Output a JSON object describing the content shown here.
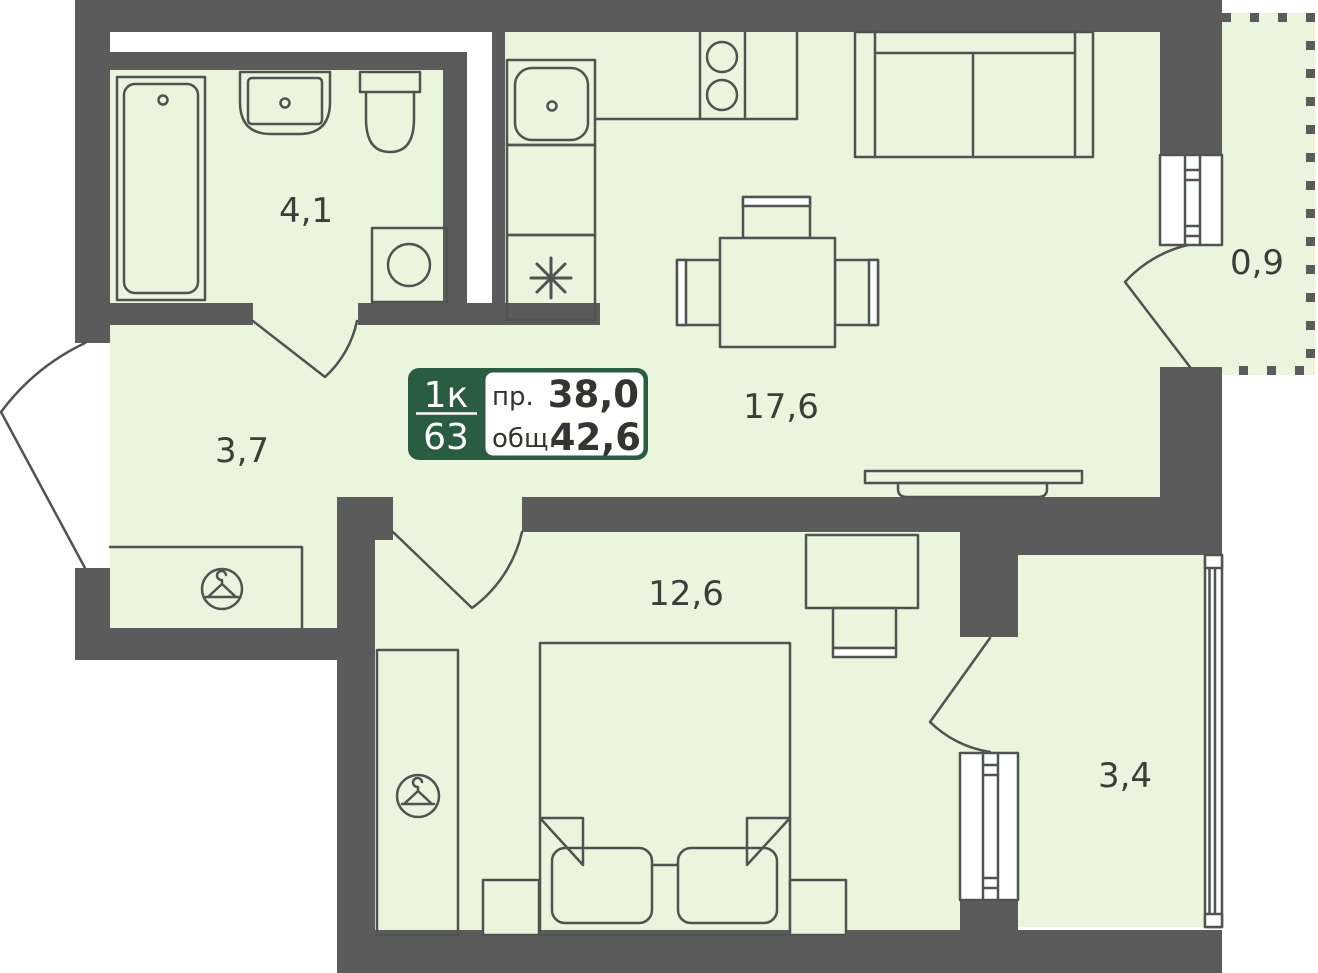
{
  "plan": {
    "title": "apartment-floor-plan",
    "info_box": {
      "apartment_type": "1к",
      "apartment_number": "63",
      "living_label": "пр.",
      "living_value": "38,0",
      "total_label": "общ.",
      "total_value": "42,6"
    },
    "rooms": {
      "bathroom": {
        "name": "bathroom",
        "area": "4,1"
      },
      "hallway": {
        "name": "hallway",
        "area": "3,7"
      },
      "kitchen_living": {
        "name": "kitchen-living-room",
        "area": "17,6"
      },
      "balcony": {
        "name": "balcony",
        "area": "0,9"
      },
      "bedroom": {
        "name": "bedroom",
        "area": "12,6"
      },
      "loggia": {
        "name": "loggia",
        "area": "3,4"
      }
    },
    "icons": [
      "hanger-icon",
      "fridge-asterisk-icon"
    ],
    "fixtures": [
      "bathtub",
      "washbasin",
      "toilet",
      "washing-machine",
      "kitchen-sink",
      "stove",
      "fridge",
      "dining-table",
      "chairs",
      "sofa",
      "radiator",
      "double-bed",
      "pillows",
      "nightstands",
      "wardrobe",
      "desk",
      "desk-chair",
      "windows",
      "doors"
    ],
    "colors": {
      "floor": "#eaf5de",
      "wall": "#5b5b5b",
      "line": "#4e544f",
      "accent_green": "#2a5c41",
      "text": "#32362f",
      "background": "#ffffff"
    }
  }
}
